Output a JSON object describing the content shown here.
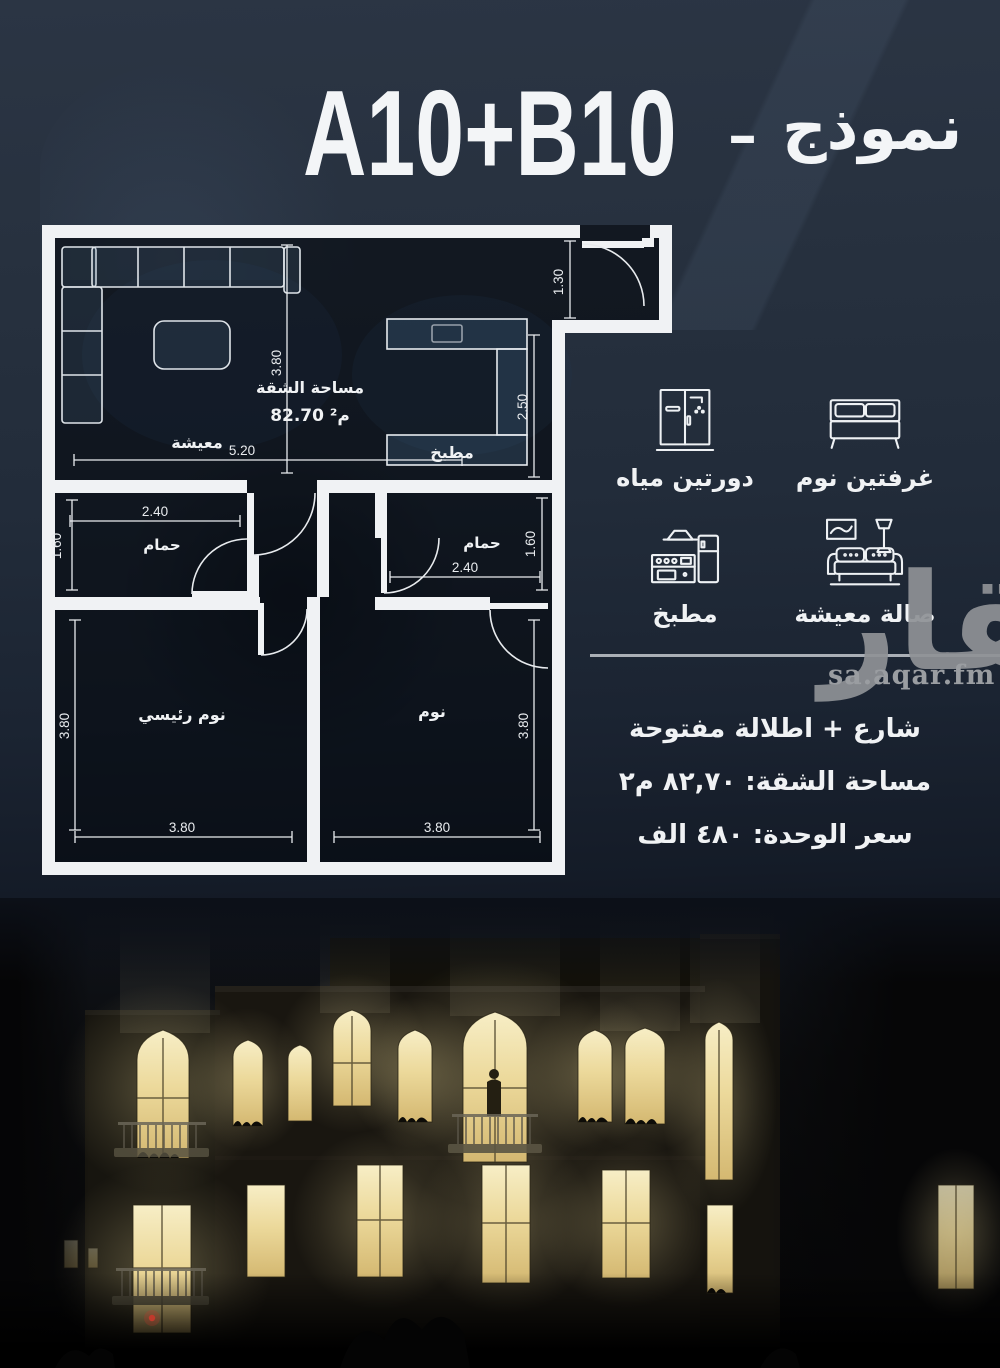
{
  "title": {
    "code": "A10+B10",
    "dash": "–",
    "model_word": "نموذج"
  },
  "plan": {
    "labels": {
      "living": "معيشة",
      "kitchen": "مطبخ",
      "bath_left": "حمام",
      "bath_right": "حمام",
      "master": "نوم رئيسي",
      "bedroom": "نوم"
    },
    "area": {
      "title": "مساحة الشقة",
      "value": "م² 82.70"
    },
    "dims": {
      "living_h": "3.80",
      "living_w": "5.20",
      "entry_w": "1.30",
      "kitchen_h": "2.50",
      "bath_left_w": "2.40",
      "bath_left_h": "1.60",
      "bath_right_w": "2.40",
      "bath_right_h": "1.60",
      "master_h": "3.80",
      "master_w": "3.80",
      "bedroom_h": "3.80",
      "bedroom_w": "3.80"
    }
  },
  "features": [
    {
      "icon": "bed-icon",
      "label": "غرفتين نوم"
    },
    {
      "icon": "shower-icon",
      "label": "دورتين مياه"
    },
    {
      "icon": "sofa-icon",
      "label": "صالة معيشة"
    },
    {
      "icon": "kitchen-icon",
      "label": "مطبخ"
    }
  ],
  "details": {
    "line1": "شارع + اطلالة مفتوحة",
    "line2": "مساحة الشقة: ٨٢,٧٠ م٢",
    "line3": "سعر الوحدة: ٤٨٠ الف"
  },
  "watermark": {
    "logo": "عقار",
    "domain": "sa.aqar.fm"
  },
  "colors": {
    "background": "#222c3a",
    "wall": "#f0f2f4",
    "window_glow": "#ecd99b",
    "watermark_gray": "#8f9296"
  }
}
